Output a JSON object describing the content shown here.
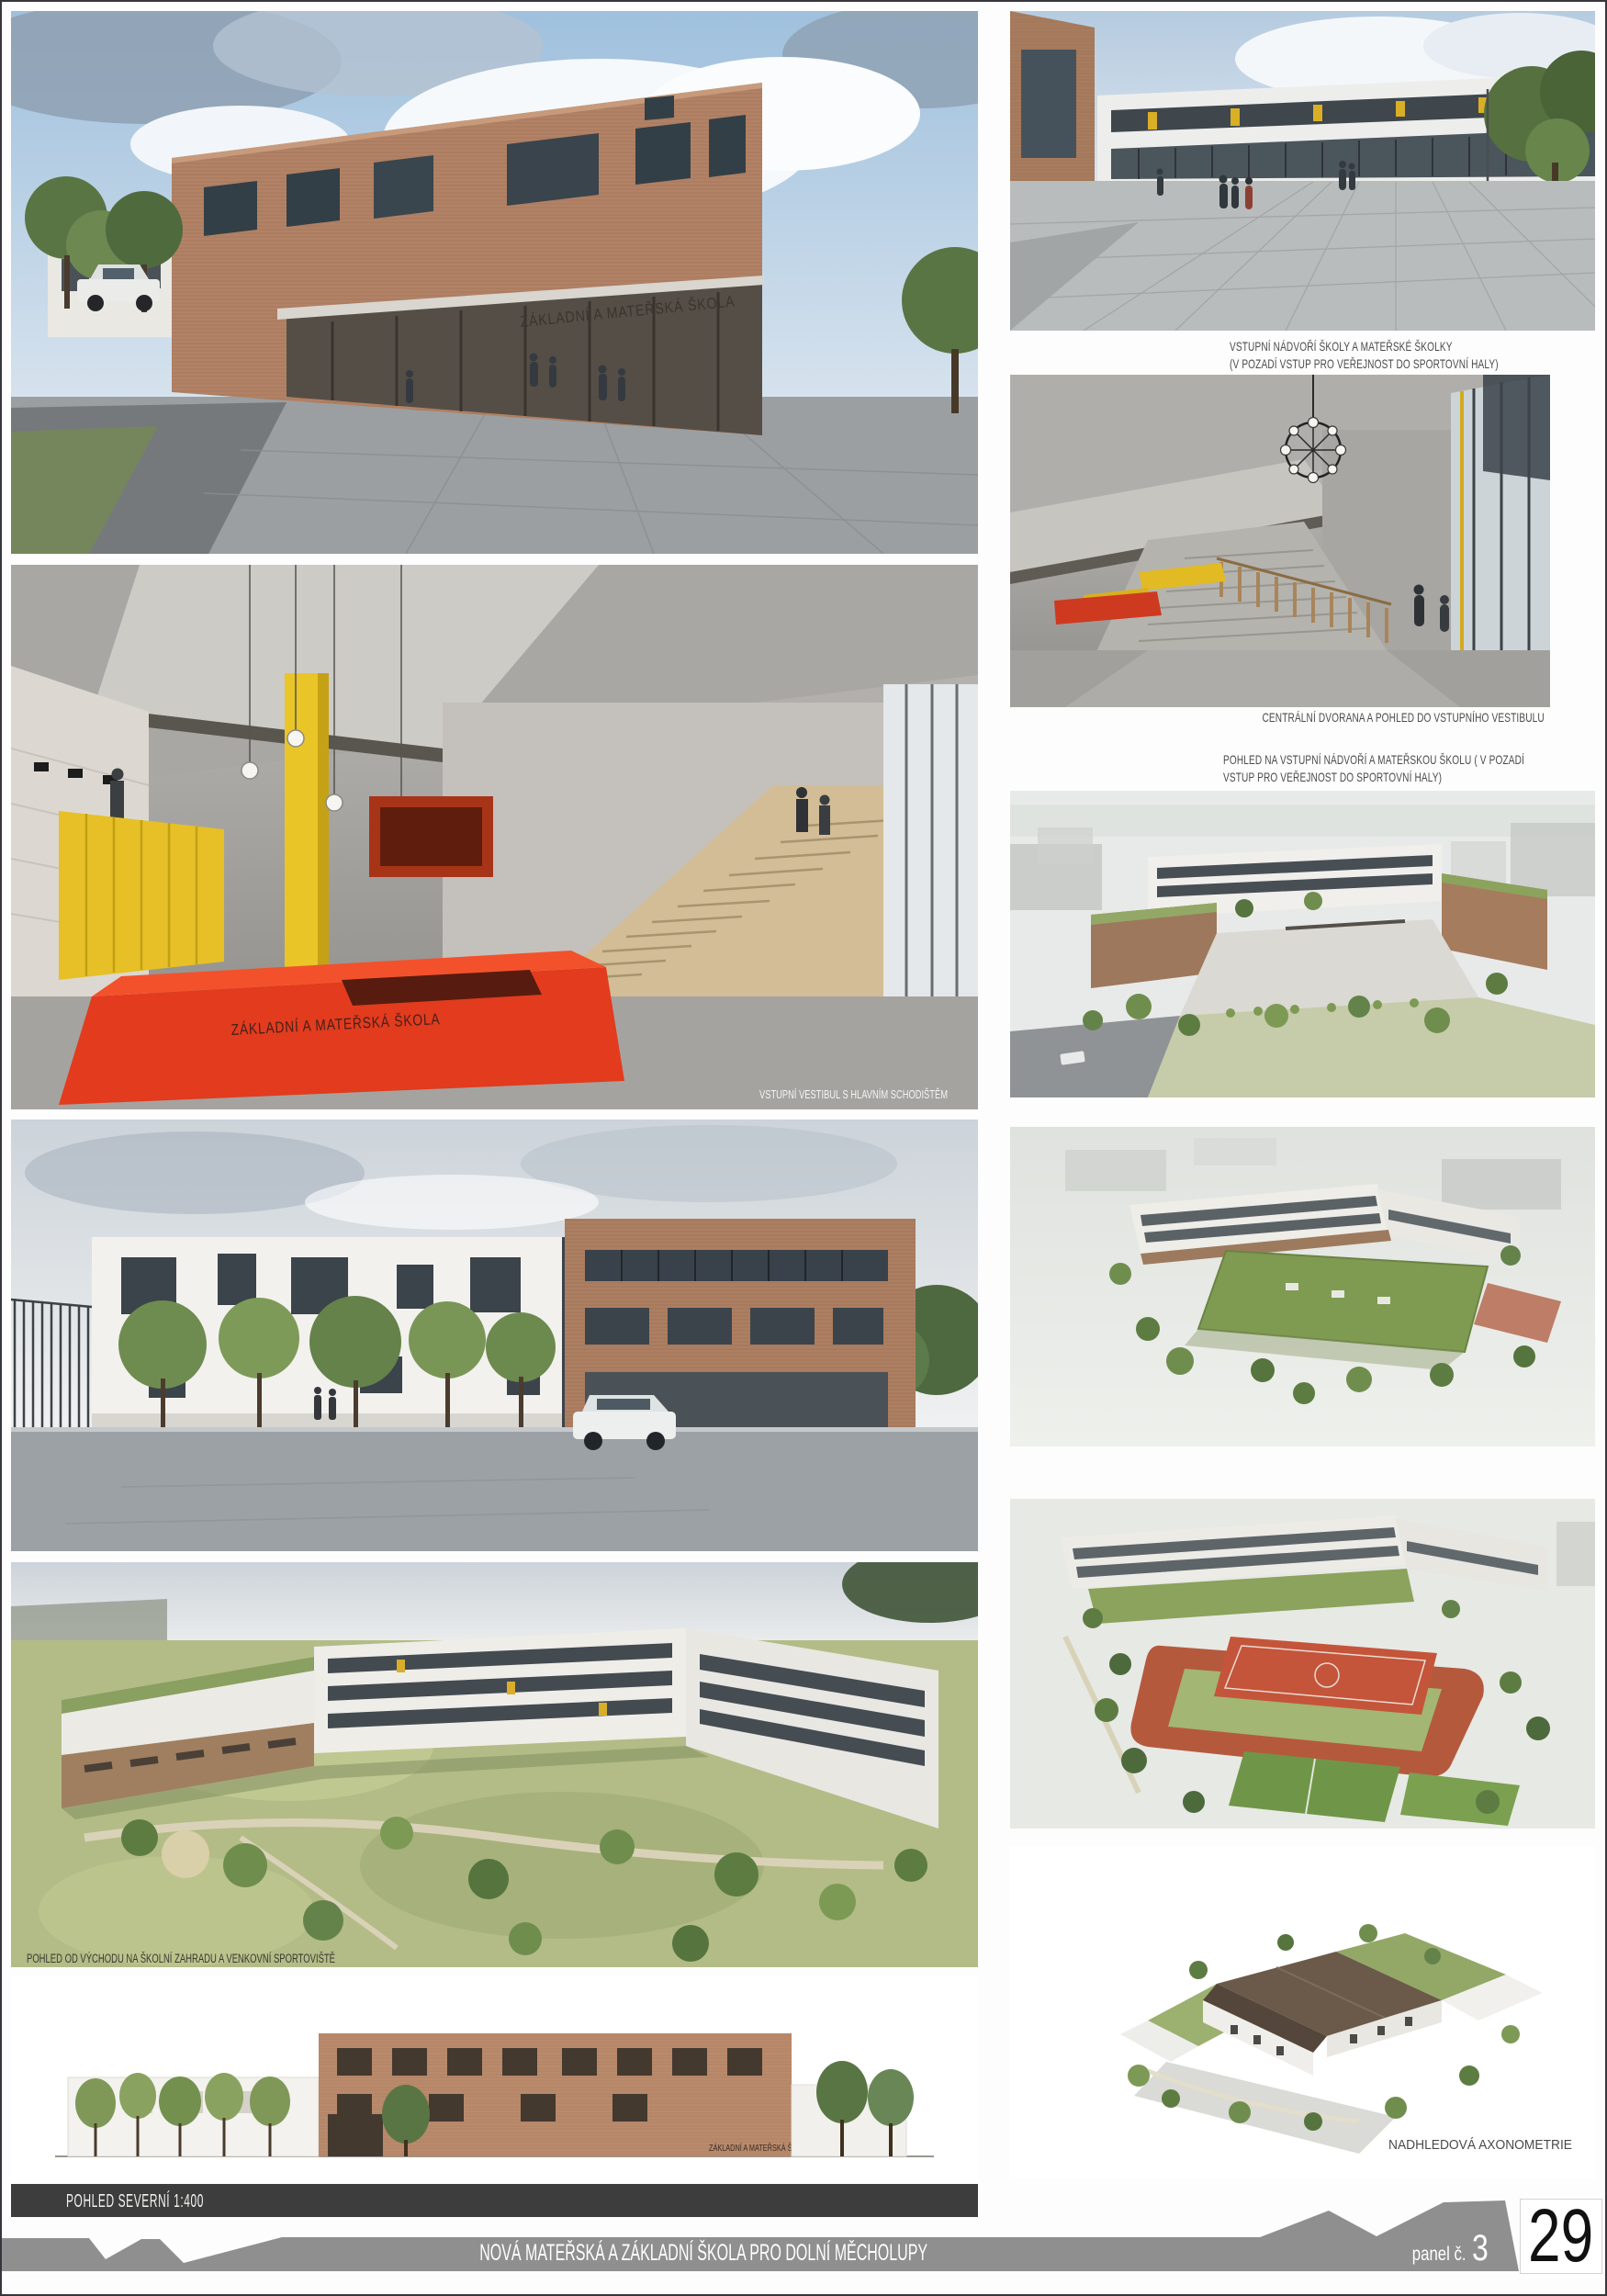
{
  "colors": {
    "accent_red": "#e23b1e",
    "brick": "#b08266",
    "banner_gray": "#8f8f8f",
    "dark_caption_bar": "#3d3d3d",
    "caption_text": "#4b4b4b",
    "sheet_number_text": "#111111"
  },
  "footer": {
    "project_title": "NOVÁ MATEŘSKÁ A ZÁKLADNÍ ŠKOLA PRO DOLNÍ MĚCHOLUPY",
    "panel_label": "panel č.",
    "panel_number": "3",
    "sheet_number": "29"
  },
  "left_column": {
    "entrance_render": {
      "building_sign": "ZÁKLADNÍ A MATEŘSKÁ ŠKOLA"
    },
    "vestibule_render": {
      "desk_sign": "ZÁKLADNÍ A MATEŘSKÁ ŠKOLA",
      "caption": "VSTUPNÍ VESTIBUL S HLAVNÍM SCHODIŠTĚM"
    },
    "garden_render": {
      "caption": "POHLED OD VÝCHODU NA ŠKOLNÍ ZAHRADU A VENKOVNÍ SPORTOVIŠTĚ"
    },
    "north_elevation": {
      "label": "POHLED SEVERNÍ  1:400",
      "building_sign": "ZÁKLADNÍ A MATEŘSKÁ ŠKOLA"
    }
  },
  "right_column": {
    "courtyard_caption_line1": "VSTUPNÍ NÁDVOŘÍ ŠKOLY A MATEŘSKÉ ŠKOLKY",
    "courtyard_caption_line2": "(V POZADÍ VSTUP PRO VEŘEJNOST DO SPORTOVNÍ HALY)",
    "hall_caption": "CENTRÁLNÍ DVORANA A POHLED DO VSTUPNÍHO VESTIBULU",
    "aerial_caption_line1": "POHLED NA VSTUPNÍ NÁDVOŘÍ A MATEŘSKOU ŠKOLU ( V POZADÍ",
    "aerial_caption_line2": "VSTUP PRO VEŘEJNOST DO SPORTOVNÍ HALY)",
    "axonometry_caption": "NADHLEDOVÁ AXONOMETRIE"
  }
}
